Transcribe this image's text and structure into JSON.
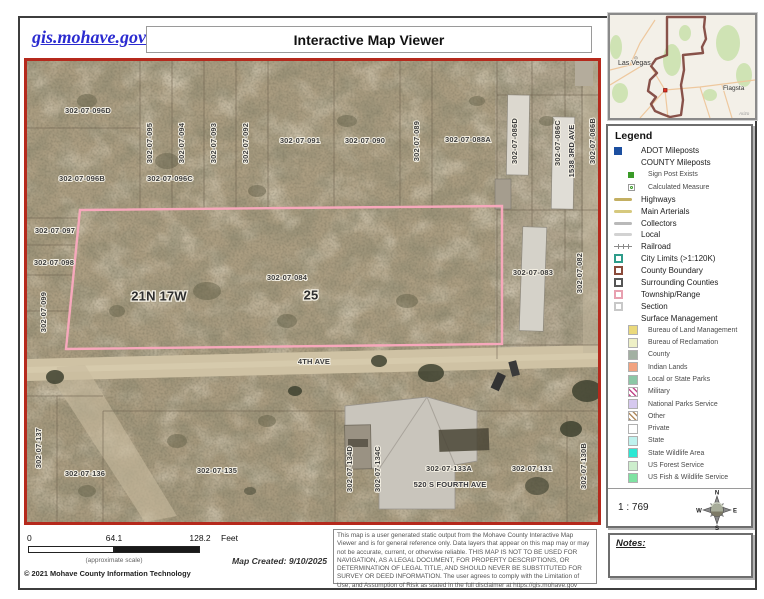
{
  "header": {
    "site_link": "gis.mohave.gov",
    "title": "Interactive Map Viewer"
  },
  "map": {
    "labels": [
      {
        "text": "302-07-096D",
        "x": 61,
        "y": 50,
        "v": 0
      },
      {
        "text": "302-07-096B",
        "x": 55,
        "y": 118,
        "v": 0
      },
      {
        "text": "302-07-096C",
        "x": 143,
        "y": 118,
        "v": 0
      },
      {
        "text": "302-07-095",
        "x": 123,
        "y": 82,
        "v": 1
      },
      {
        "text": "302-07-094",
        "x": 155,
        "y": 82,
        "v": 1
      },
      {
        "text": "302-07-093",
        "x": 187,
        "y": 82,
        "v": 1
      },
      {
        "text": "302-07-092",
        "x": 219,
        "y": 82,
        "v": 1
      },
      {
        "text": "302-07-091",
        "x": 273,
        "y": 80,
        "v": 0
      },
      {
        "text": "302-07-090",
        "x": 338,
        "y": 80,
        "v": 0
      },
      {
        "text": "302-07-089",
        "x": 390,
        "y": 80,
        "v": 1
      },
      {
        "text": "302-07-088A",
        "x": 441,
        "y": 79,
        "v": 0
      },
      {
        "text": "302-07-086D",
        "x": 488,
        "y": 80,
        "v": 1
      },
      {
        "text": "302-07-086C",
        "x": 531,
        "y": 82,
        "v": 1
      },
      {
        "text": "1538 3RD AVE",
        "x": 545,
        "y": 90,
        "v": 1,
        "addr": 1
      },
      {
        "text": "302-07-086B",
        "x": 566,
        "y": 80,
        "v": 1
      },
      {
        "text": "302-07-097",
        "x": 28,
        "y": 170,
        "v": 0
      },
      {
        "text": "302-07-098",
        "x": 27,
        "y": 202,
        "v": 0
      },
      {
        "text": "302-07-099",
        "x": 17,
        "y": 251,
        "v": 1
      },
      {
        "text": "21N 17W",
        "x": 132,
        "y": 236,
        "v": 0,
        "big": 1
      },
      {
        "text": "302-07-084",
        "x": 260,
        "y": 217,
        "v": 0
      },
      {
        "text": "25",
        "x": 284,
        "y": 235,
        "v": 0,
        "big": 1
      },
      {
        "text": "302-07-083",
        "x": 506,
        "y": 212,
        "v": 0
      },
      {
        "text": "302-07-082",
        "x": 553,
        "y": 212,
        "v": 1
      },
      {
        "text": "4TH  AVE",
        "x": 287,
        "y": 301,
        "v": 0
      },
      {
        "text": "302-07-137",
        "x": 12,
        "y": 387,
        "v": 1
      },
      {
        "text": "302-07-136",
        "x": 58,
        "y": 413,
        "v": 0
      },
      {
        "text": "302-07-135",
        "x": 190,
        "y": 410,
        "v": 0
      },
      {
        "text": "302-07-134D",
        "x": 323,
        "y": 408,
        "v": 1
      },
      {
        "text": "302-07-134C",
        "x": 351,
        "y": 408,
        "v": 1
      },
      {
        "text": "302-07-133A",
        "x": 422,
        "y": 408,
        "v": 0
      },
      {
        "text": "520 S FOURTH AVE",
        "x": 423,
        "y": 424,
        "v": 0,
        "addr": 1
      },
      {
        "text": "302-07-131",
        "x": 505,
        "y": 408,
        "v": 0
      },
      {
        "text": "302-07-130B",
        "x": 557,
        "y": 405,
        "v": 1
      }
    ]
  },
  "inset": {
    "city1": "Las Vegas",
    "city2": "Flagsta",
    "attr": "Arizo"
  },
  "legend": {
    "title": "Legend",
    "items": [
      {
        "label": "ADOT Mileposts",
        "type": "square",
        "color": "#1c4fa0",
        "indent": 0
      },
      {
        "label": "COUNTY Mileposts",
        "type": "none",
        "color": "",
        "indent": 0
      },
      {
        "label": "Sign Post Exists",
        "type": "square-small",
        "color": "#3a9a28",
        "indent": 1
      },
      {
        "label": "Calculated Measure",
        "type": "dot-box",
        "color": "#3a9a28",
        "indent": 1
      },
      {
        "label": "Highways",
        "type": "line",
        "color": "#c3af62",
        "indent": 0
      },
      {
        "label": "Main Arterials",
        "type": "line",
        "color": "#d6c97e",
        "indent": 0
      },
      {
        "label": "Collectors",
        "type": "line",
        "color": "#b9b9b9",
        "indent": 0
      },
      {
        "label": "Local",
        "type": "line",
        "color": "#d2d2d2",
        "indent": 0
      },
      {
        "label": "Railroad",
        "type": "rail",
        "color": "#8a8a8a",
        "indent": 0
      },
      {
        "label": "City Limits (>1:120K)",
        "type": "outline",
        "color": "#2e9c8a",
        "indent": 0
      },
      {
        "label": "County Boundary",
        "type": "outline",
        "color": "#8a4a3a",
        "indent": 0
      },
      {
        "label": "Surrounding Counties",
        "type": "outline",
        "color": "#555555",
        "indent": 0
      },
      {
        "label": "Township/Range",
        "type": "outline",
        "color": "#e8a0b0",
        "indent": 0
      },
      {
        "label": "Section",
        "type": "outline",
        "color": "#c8c8c8",
        "indent": 0
      },
      {
        "label": "Surface Management",
        "type": "none",
        "color": "",
        "indent": 0
      },
      {
        "label": "Bureau of Land Management",
        "type": "fill",
        "color": "#ead97c",
        "indent": 1
      },
      {
        "label": "Bureau of Reclamation",
        "type": "fill",
        "color": "#eef0c6",
        "indent": 1
      },
      {
        "label": "County",
        "type": "fill",
        "color": "#a2b0a2",
        "indent": 1
      },
      {
        "label": "Indian Lands",
        "type": "fill",
        "color": "#f2a380",
        "indent": 1
      },
      {
        "label": "Local or State Parks",
        "type": "fill",
        "color": "#8cc7a6",
        "indent": 1
      },
      {
        "label": "Military",
        "type": "hatch",
        "color": "#c2488a",
        "indent": 1
      },
      {
        "label": "National Parks Service",
        "type": "fill",
        "color": "#d6c9ef",
        "indent": 1
      },
      {
        "label": "Other",
        "type": "hatch",
        "color": "#b08a5e",
        "indent": 1
      },
      {
        "label": "Private",
        "type": "fill",
        "color": "#ffffff",
        "indent": 1
      },
      {
        "label": "State",
        "type": "fill",
        "color": "#bff2ee",
        "indent": 1
      },
      {
        "label": "State Wildlife Area",
        "type": "fill",
        "color": "#2ce8d4",
        "indent": 1
      },
      {
        "label": "US Forest Service",
        "type": "fill",
        "color": "#cdeecd",
        "indent": 1
      },
      {
        "label": "US Fish & Wildlife Service",
        "type": "fill",
        "color": "#7fe2a2",
        "indent": 1
      }
    ],
    "scale_text": "1 : 769",
    "compass": {
      "n": "N",
      "s": "S",
      "e": "E",
      "w": "W"
    }
  },
  "notes": {
    "label": "Notes:"
  },
  "scalebar": {
    "tick0": "0",
    "tick1": "64.1",
    "tick2": "128.2",
    "unit": "Feet",
    "approx": "(approximate scale)",
    "copyright": "© 2021 Mohave County Information Technology",
    "created": "Map Created: 9/10/2025"
  },
  "disclaimer": "This map is a user generated static output from the Mohave County Interactive Map Viewer and is for general reference only. Data layers that appear on this map may or may not be accurate, current, or otherwise reliable. THIS MAP IS NOT TO BE USED FOR NAVIGATION, AS A LEGAL DOCUMENT, FOR PROPERTY DESCRIPTIONS, OR DETERMINATION OF LEGAL TITLE, AND SHOULD NEVER BE SUBSTITUTED FOR SURVEY OR DEED INFORMATION. The user agrees to comply with the Limitation of Use, and Assumption of Risk as stated in the full disclaimer at https://gis.mohave.gov"
}
